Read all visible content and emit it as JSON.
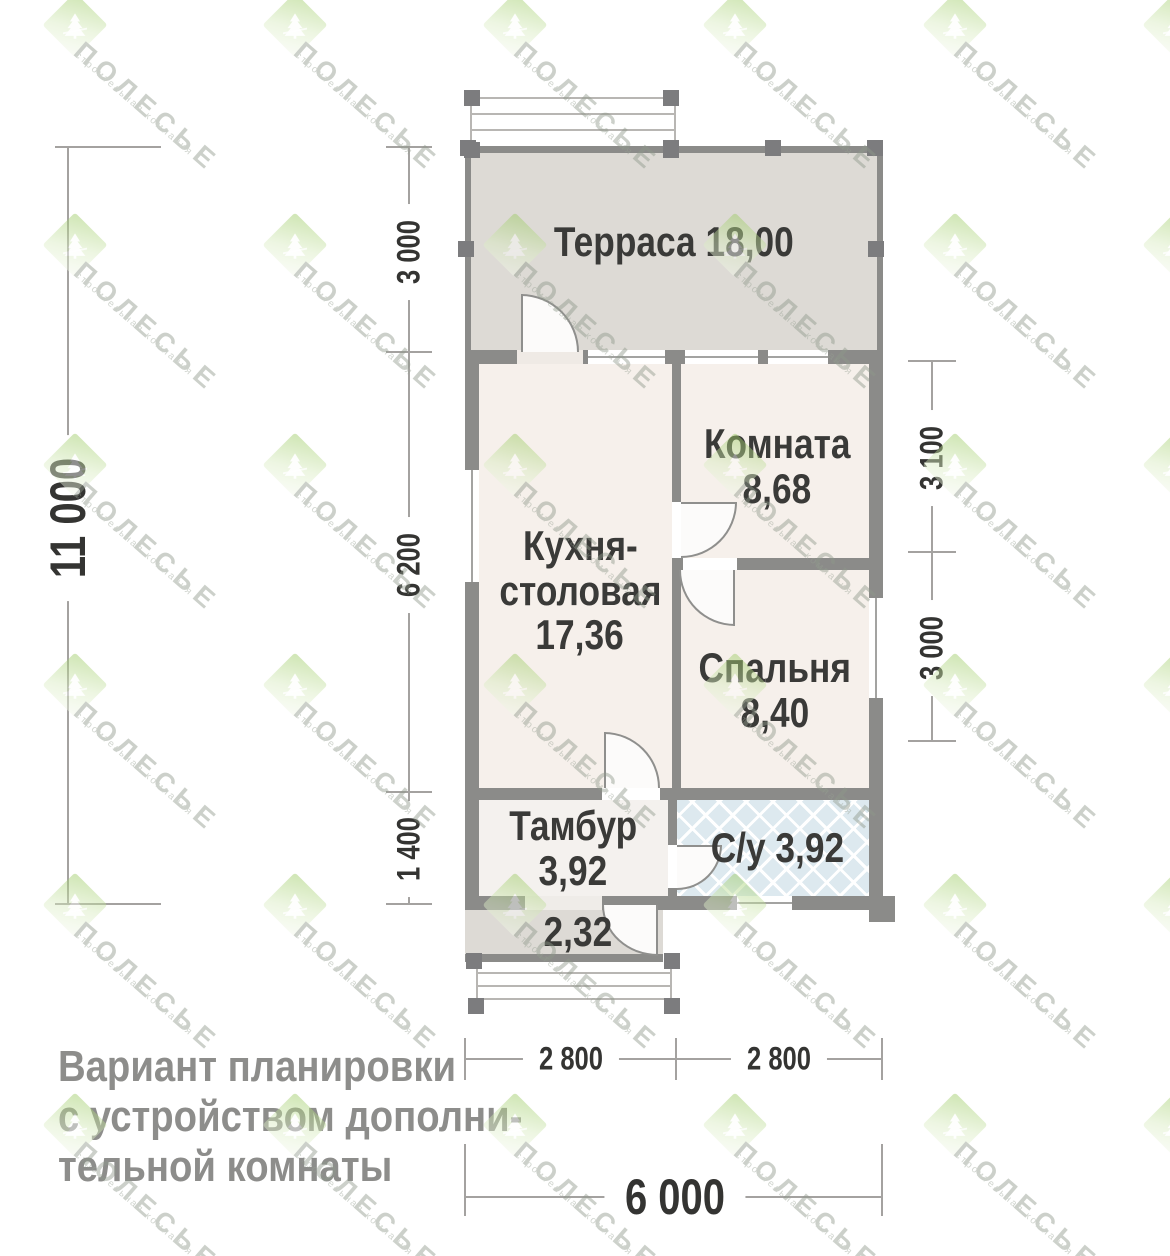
{
  "watermark": {
    "brand": "ПОЛЕСЬЕ",
    "tagline": "строительная компания"
  },
  "plan": {
    "rooms": {
      "terrace": {
        "label": "Терраса",
        "area": "18,00"
      },
      "kitchen": {
        "line1": "Кухня-",
        "line2": "столовая",
        "area": "17,36"
      },
      "room": {
        "label": "Комната",
        "area": "8,68"
      },
      "bedroom": {
        "label": "Спальня",
        "area": "8,40"
      },
      "tambour": {
        "label": "Тамбур",
        "area": "3,92"
      },
      "wc": {
        "label": "С/у",
        "area": "3,92"
      },
      "porch": {
        "area": "2,32"
      }
    },
    "dimensions": {
      "left_total": "11 000",
      "left_terrace": "3 000",
      "left_main": "6 200",
      "left_tambour": "1 400",
      "right_room": "3 100",
      "right_bedroom": "3 000",
      "bottom_left": "2 800",
      "bottom_right": "2 800",
      "bottom_total": "6 000"
    }
  },
  "caption": {
    "lines": [
      "Вариант планировки",
      "с устройством дополни-",
      "тельной комнаты"
    ]
  },
  "colors": {
    "wall": "#8b8b89",
    "room_fill": "#f6f0eb",
    "terrace_fill": "#dddad5",
    "wc_tile": "#dde9ef",
    "brand_green": "#9ccb63",
    "label_text": "#3a3a38",
    "caption_text": "#8d8d8b"
  }
}
